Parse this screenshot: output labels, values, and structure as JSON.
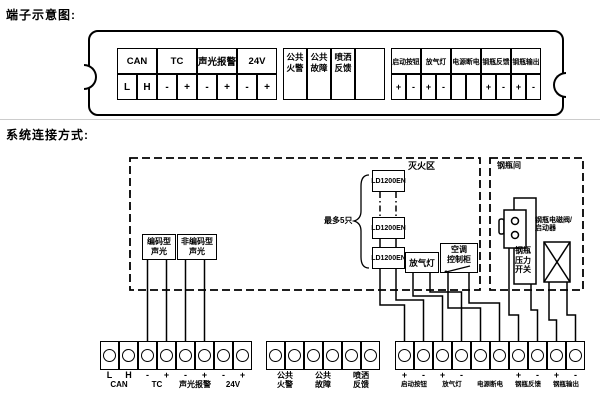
{
  "titles": {
    "terminal_schematic": "端子示意图:",
    "system_connection": "系统连接方式:"
  },
  "terminal_strip": {
    "group_a": {
      "headers": [
        "CAN",
        "TC",
        "声光报警",
        "24V"
      ],
      "cells": [
        "L",
        "H",
        "-",
        "+",
        "-",
        "+",
        "-",
        "+"
      ]
    },
    "group_b": {
      "labels": [
        [
          "公共",
          "火警"
        ],
        [
          "公共",
          "故障"
        ],
        [
          "喷洒",
          "反馈"
        ]
      ]
    },
    "group_c": {
      "headers": [
        "启动按钮",
        "放气灯",
        "电源断电",
        "钢瓶反馈",
        "钢瓶输出"
      ],
      "cells": [
        "+",
        "-",
        "+",
        "-",
        "",
        "",
        "+",
        "-",
        "+",
        "-"
      ]
    }
  },
  "diagram": {
    "zone_label": "灭火区",
    "cylinder_room_label": "钢瓶间",
    "coded_sounder": [
      "编码型",
      "声光"
    ],
    "noncoded_sounder": [
      "非编码型",
      "声光"
    ],
    "modules": [
      "LD1200EN",
      "LD1200EN",
      "LD1200EN"
    ],
    "max_note": "最多5只",
    "gas_release_lamp": "放气灯",
    "ac_cabinet": [
      "空调",
      "控制柜"
    ],
    "pressure_switch": [
      "钢瓶",
      "压力",
      "开关"
    ],
    "solenoid": [
      "钢瓶电磁阀/",
      "启动器"
    ]
  },
  "blocks": {
    "left": {
      "signs": [
        "L",
        "H",
        "-",
        "+",
        "-",
        "+",
        "-",
        "+"
      ],
      "labels": [
        "CAN",
        "TC",
        "声光报警",
        "24V"
      ]
    },
    "middle": {
      "labels": [
        [
          "公共",
          "火警"
        ],
        [
          "公共",
          "故障"
        ],
        [
          "喷洒",
          "反馈"
        ]
      ]
    },
    "right": {
      "signs": [
        "+",
        "-",
        "+",
        "-",
        "",
        "",
        "+",
        "-",
        "+",
        "-"
      ],
      "labels": [
        "启动按钮",
        "放气灯",
        "电源断电",
        "钢瓶反馈",
        "钢瓶输出"
      ]
    }
  },
  "colors": {
    "line": "#000000",
    "background": "#ffffff",
    "separator": "#cccccc"
  }
}
